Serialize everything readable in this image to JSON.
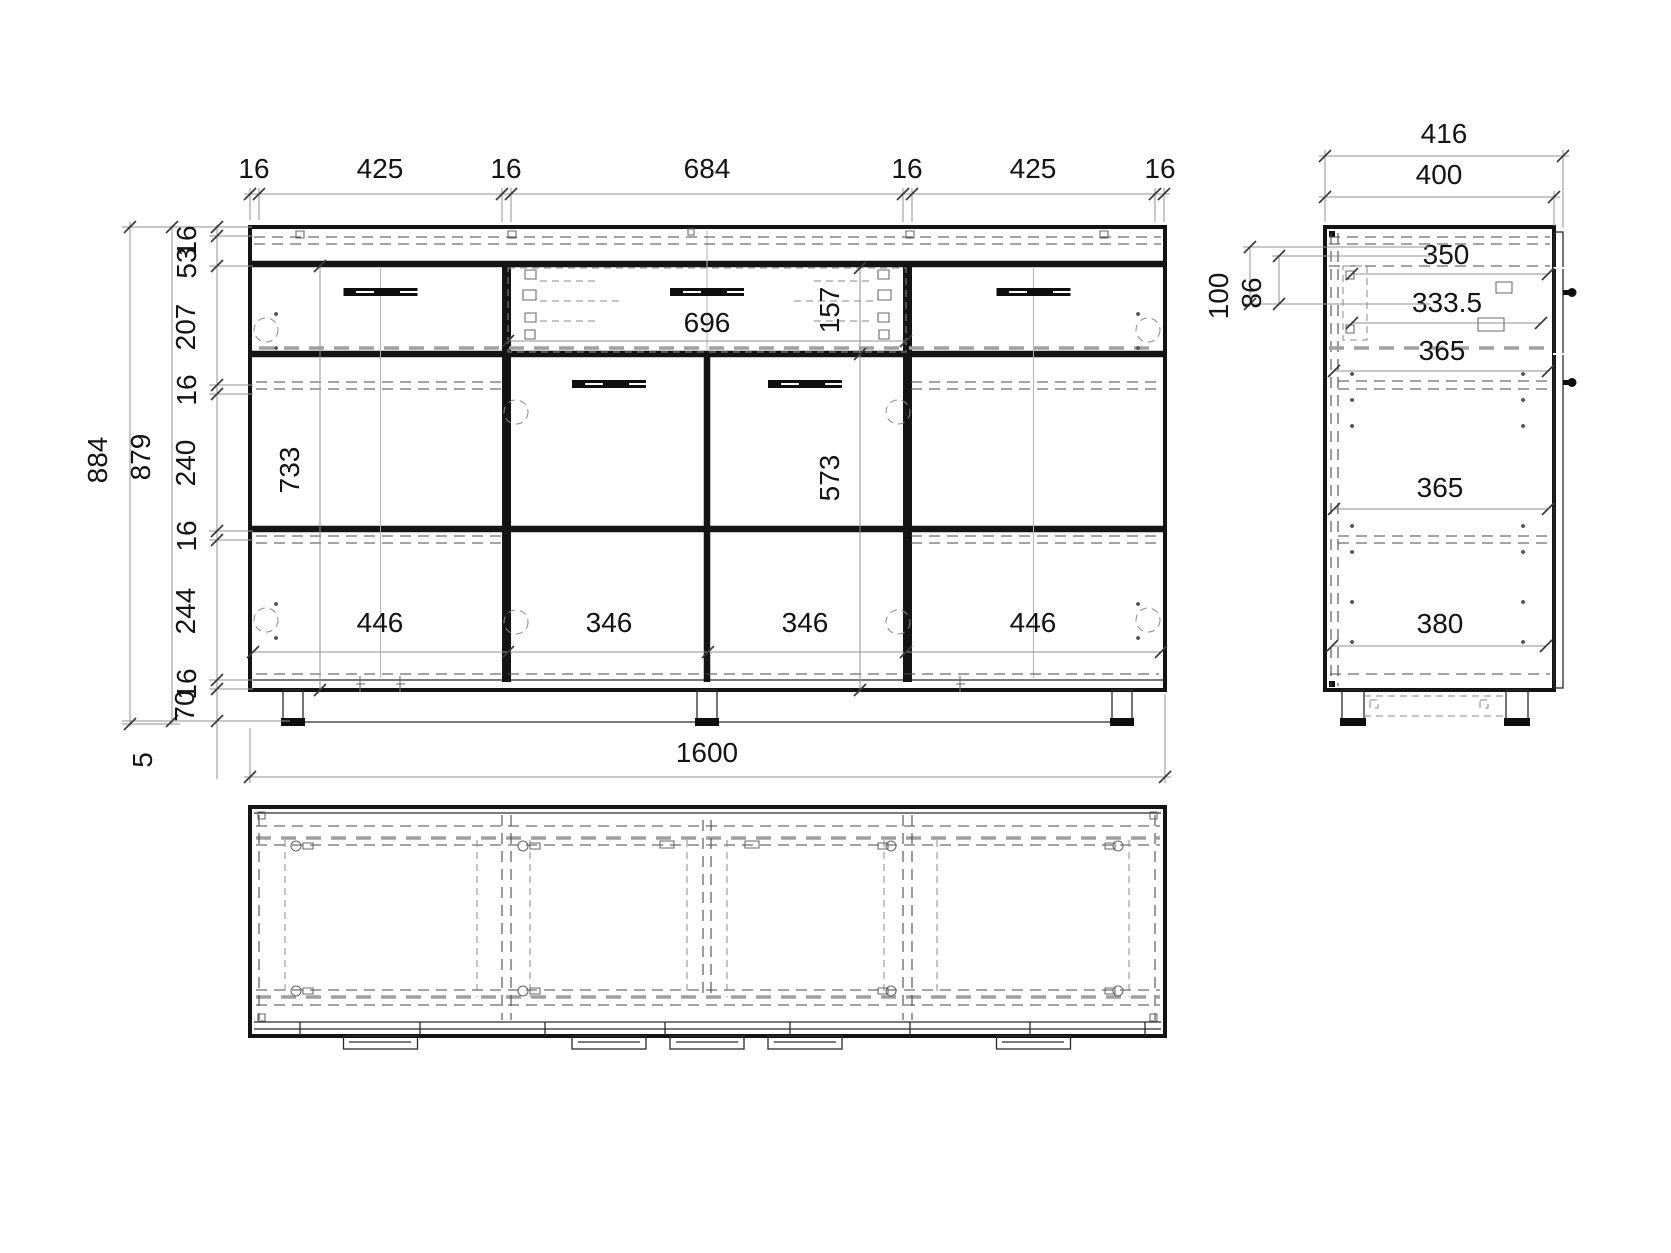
{
  "front_view": {
    "top_chain": [
      "16",
      "425",
      "16",
      "684",
      "16",
      "425",
      "16"
    ],
    "height_total": "884",
    "height_body": "879",
    "left_chain": [
      "16",
      "53",
      "207",
      "16",
      "240",
      "16",
      "244",
      "16",
      "70"
    ],
    "foot_adjust": "5",
    "width_total": "1600",
    "drawer_front_width": "696",
    "drawer_front_height": "157",
    "side_door_height": "733",
    "middle_door_height": "573",
    "front_widths": [
      "446",
      "346",
      "346",
      "446"
    ]
  },
  "side_view": {
    "depth_total": "416",
    "depth_body": "400",
    "top_offsets": [
      "100",
      "86"
    ],
    "interior_depths": [
      "350",
      "333.5",
      "365",
      "365",
      "380"
    ]
  }
}
